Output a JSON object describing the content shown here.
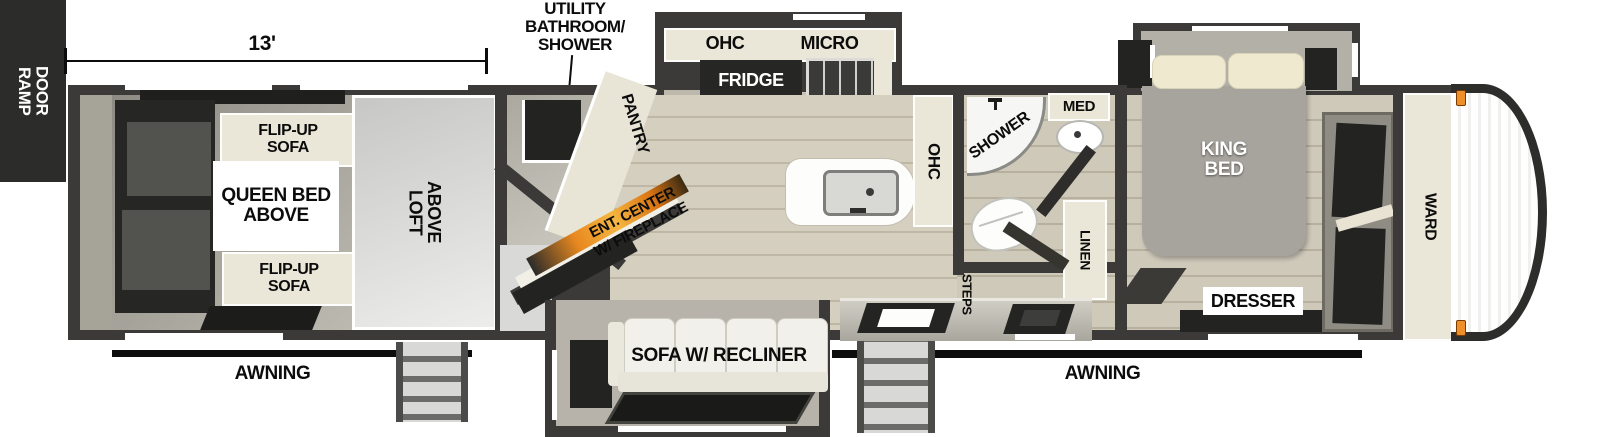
{
  "title": "Toy hauler travel trailer floorplan",
  "labels": {
    "ramp_door": "RAMP\nDOOR",
    "garage_length": "13'",
    "utility_bath": "UTILITY\nBATHROOM/\nSHOWER",
    "flip_up_sofa": "FLIP-UP\nSOFA",
    "queen_bed": "QUEEN BED\nABOVE",
    "loft": "LOFT\nABOVE",
    "pantry": "PANTRY",
    "ohc": "OHC",
    "micro": "MICRO",
    "fridge": "FRIDGE",
    "ent_center": "ENT. CENTER\nW/ FIREPLACE",
    "sofa": "SOFA W/ RECLINER",
    "shower": "SHOWER",
    "med": "MED",
    "linen": "LINEN",
    "steps": "STEPS",
    "king_bed": "KING\nBED",
    "ward": "WARD",
    "dresser": "DRESSER",
    "awning": "AWNING"
  },
  "colors": {
    "wall": "#3b3a38",
    "wood_floor": "#d2ccbd",
    "cabinet_cream": "#ebe7d8",
    "dark_fixture": "#232322",
    "fireplace_orange": "#e8891f",
    "awning_bar": "#0d0d0d",
    "marker_light": "#ef8f2a",
    "label_text": "#0c0c0c"
  }
}
